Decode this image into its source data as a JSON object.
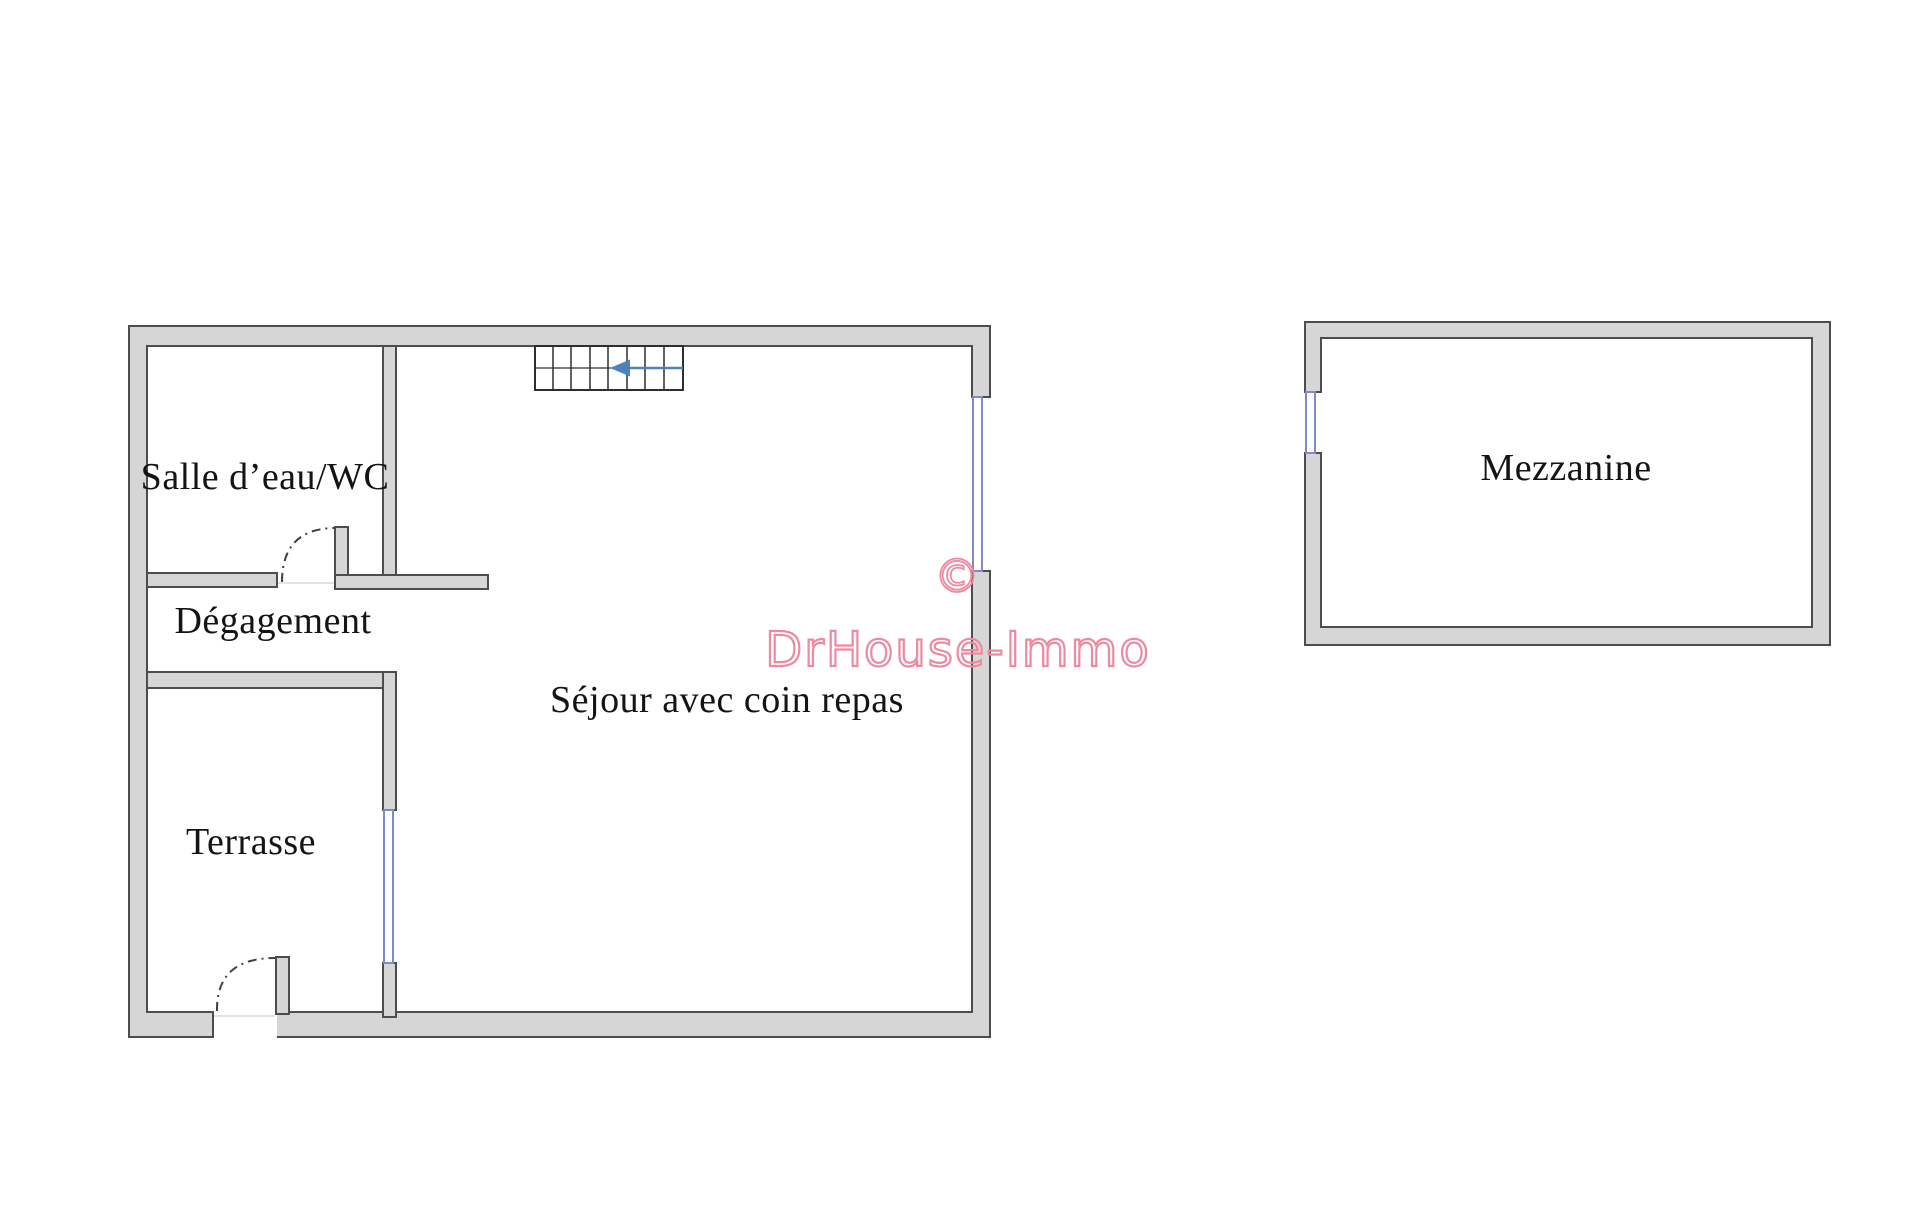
{
  "colors": {
    "wall_fill": "#d6d6d6",
    "wall_stroke": "#4d4d4d",
    "window_blue": "#8289c8",
    "stair_blue": "#4f81bd",
    "watermark_pink": "#ee8a9f",
    "label_color": "#141414"
  },
  "floorplan": {
    "rooms": [
      {
        "id": "salle-eau-wc",
        "label": "Salle d’eau/WC"
      },
      {
        "id": "degagement",
        "label": "Dégagement"
      },
      {
        "id": "terrasse",
        "label": "Terrasse"
      },
      {
        "id": "sejour",
        "label": "Séjour avec coin repas"
      },
      {
        "id": "mezzanine",
        "label": "Mezzanine"
      }
    ]
  },
  "watermark": {
    "symbol": "©",
    "text": "DrHouse-Immo"
  }
}
